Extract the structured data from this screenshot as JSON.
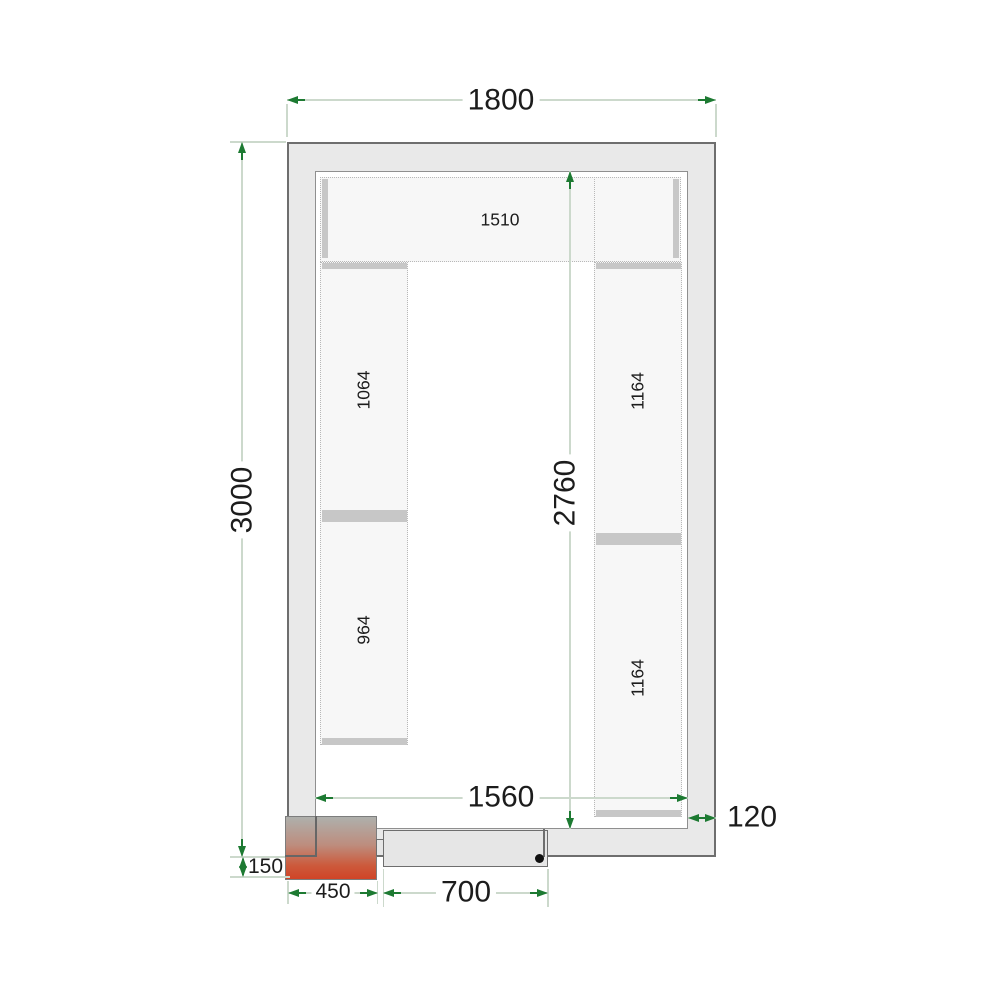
{
  "drawing": {
    "type": "cold-room-floor-plan",
    "dimensions": {
      "outer_width": "1800",
      "outer_length": "3000",
      "inner_length": "2760",
      "inner_width": "1560",
      "wall_thickness": "120",
      "unit_protrusion": "150",
      "unit_width": "450",
      "door_width": "700"
    },
    "shelves": {
      "top": "1510",
      "left_upper": "1064",
      "left_lower": "964",
      "right_upper": "1164",
      "right_lower": "1164"
    },
    "colors": {
      "arrow_green": "#1d7a32",
      "dimension_line": "#ccd9cc",
      "wall_fill": "#e9e9e9",
      "wall_border": "#6e6e6e",
      "shelf_fill": "#f7f7f7",
      "shelf_support": "#c7c7c7",
      "unit_red": "#d04427",
      "handle_black": "#111111"
    }
  }
}
